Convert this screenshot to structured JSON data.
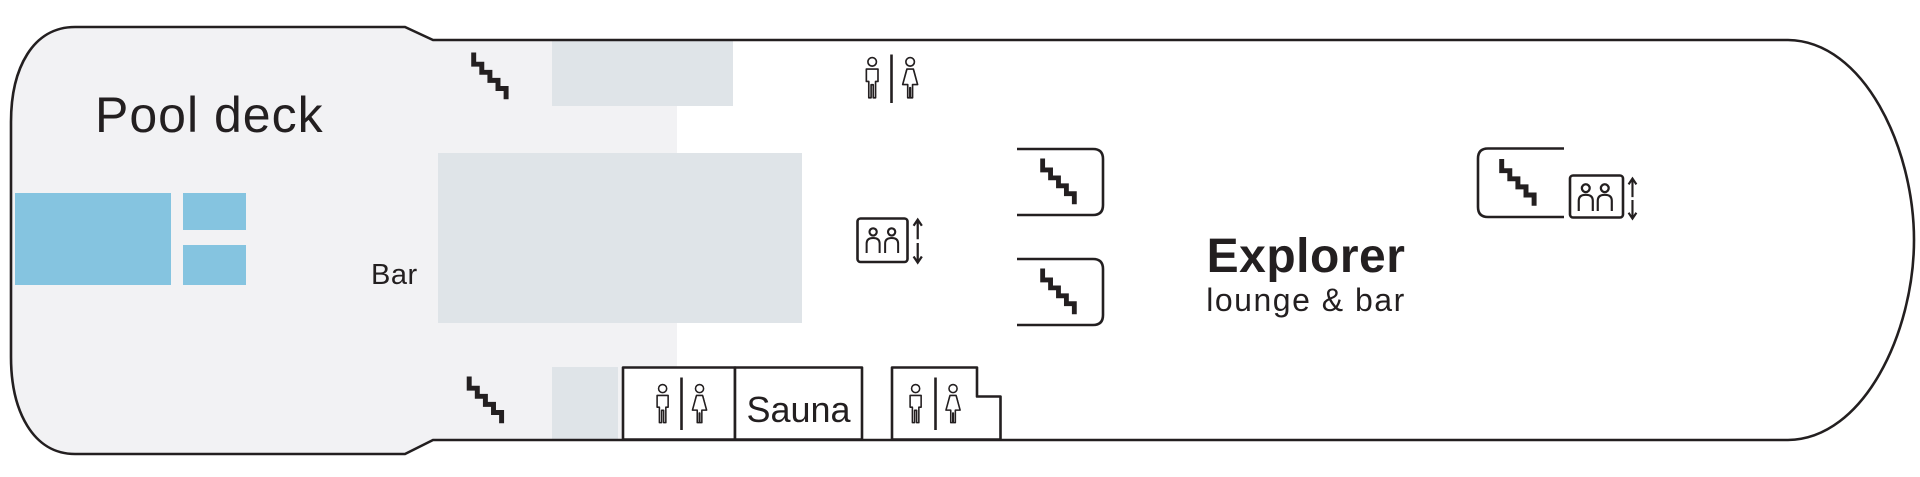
{
  "deck": {
    "pool_label": "Pool deck",
    "bar_label": "Bar",
    "lounge": {
      "title": "Explorer",
      "subtitle": "lounge & bar"
    },
    "sauna_label": "Sauna"
  },
  "colors": {
    "outline": "#231f20",
    "deck_area": "#f2f2f4",
    "structure": "#dfe4e8",
    "pool": "#85c4e0",
    "room": "#ffffff"
  },
  "icons": {
    "stairs": "stairs-icon",
    "elevator_passengers": "elevator-passengers-icon",
    "male_restroom": "male-restroom-icon",
    "female_restroom": "female-restroom-icon",
    "arrow_up": "up-arrow-icon",
    "arrow_down": "down-arrow-icon"
  }
}
